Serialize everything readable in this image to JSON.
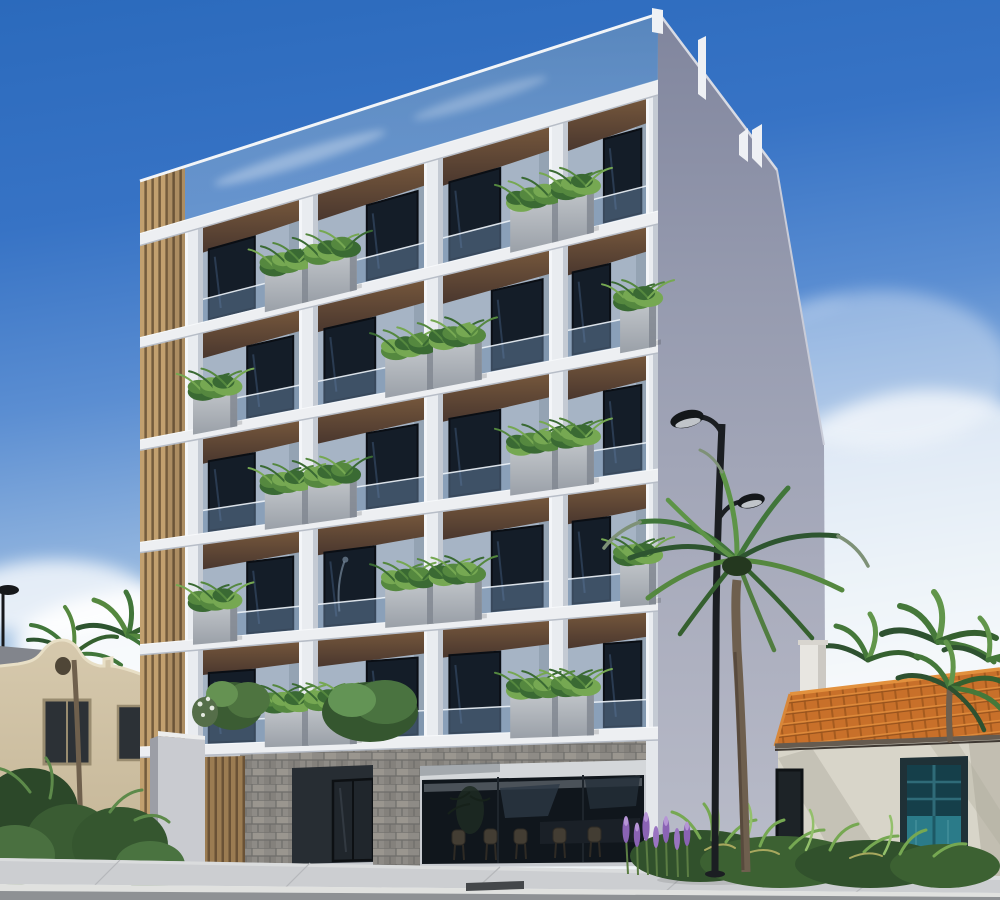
{
  "scene": {
    "type": "3d-architectural-exterior-render",
    "setting": "sunny-day-street-view",
    "description": "Modern five-storey condo building seen from the street corner: white concrete grid facade of planted balconies, glass roof parapet, wood-slat accent column, stone-clad ground floor with tinted storefront glass, flanked by a Spanish-colonial beige house on the left and a terracotta tile-roof cottage with a teal door on the right; palm trees, a black double-arm street lamp, lavender flower bed and a grey sidewalk in front under a blue sky with wispy clouds.",
    "objects": [
      "sky",
      "clouds",
      "condo-building",
      "side-wall",
      "balcony-grid",
      "planter-boxes",
      "street-lamp",
      "palm-trees",
      "left-house",
      "right-house",
      "courtyard-wall",
      "storefront",
      "entrance-door",
      "flower-bed",
      "sidewalk",
      "road"
    ]
  },
  "sky": {
    "top_color": "#2b6abc",
    "mid_color": "#5b8ed2",
    "horizon_color": "#eef3f6",
    "cloud_color": "#ffffff"
  },
  "building": {
    "floors": 5,
    "bays": 4,
    "balcony_cells": 20,
    "features": [
      "glass roof parapet",
      "white concrete grid",
      "wood slat accent column",
      "wood soffit ceilings",
      "frameless glass balustrades",
      "concrete planter boxes with ferns",
      "stone clad ground piers",
      "tinted glass storefront with cafe stools",
      "recessed glass entrance",
      "wood slat gate"
    ],
    "colors": {
      "frame_white": "#e9ecf0",
      "slab_white": "#edeff2",
      "back_wall": "#a6b4c5",
      "window_glass": "#141d28",
      "balustrade_glass": "#6c8aac",
      "parapet_glass": "#6f94ba",
      "soffit_top": "#75573c",
      "soffit_bottom": "#4a372e",
      "planter_top": "#c3c7cb",
      "planter_bottom": "#9aa0a8",
      "planter_shade": "#7e858e",
      "wood_slat_light": "#c2a06f",
      "wood_slat_dark": "#7d6342",
      "side_wall_top": "#80859d",
      "side_wall_bottom": "#b9bcc9",
      "stone_base": "#8e8b86",
      "storefront_glass": "#10161c",
      "plant_greens": [
        "#3a6a33",
        "#55883f",
        "#76a852"
      ]
    }
  },
  "left_house": {
    "style": "spanish-colonial-parapet",
    "wall_color": "#d2c5a9",
    "roof_color": "#82858c",
    "window_color": "#2c3136",
    "trim_color": "#998c70"
  },
  "right_house": {
    "style": "terracotta-roof-cottage",
    "roof_tile_color": "#c8702a",
    "roof_highlight": "#de8a3a",
    "wall_color": "#d8d5c9",
    "door_color": "#2b7b89",
    "door_frame_color": "#1f3137",
    "chimney_color": "#e8e6e1"
  },
  "street": {
    "lamp_color": "#1b1e22",
    "lamp_heads": 2,
    "sidewalk_color": "#ccced1",
    "curb_color": "#e0e1df",
    "road_color": "#8e9194",
    "grate_color": "#44474a",
    "flower_colors": [
      "#8a63b4",
      "#b695d6"
    ],
    "foliage_colors": [
      "#2e5530",
      "#41763a",
      "#5d9447",
      "#7dae58"
    ]
  }
}
